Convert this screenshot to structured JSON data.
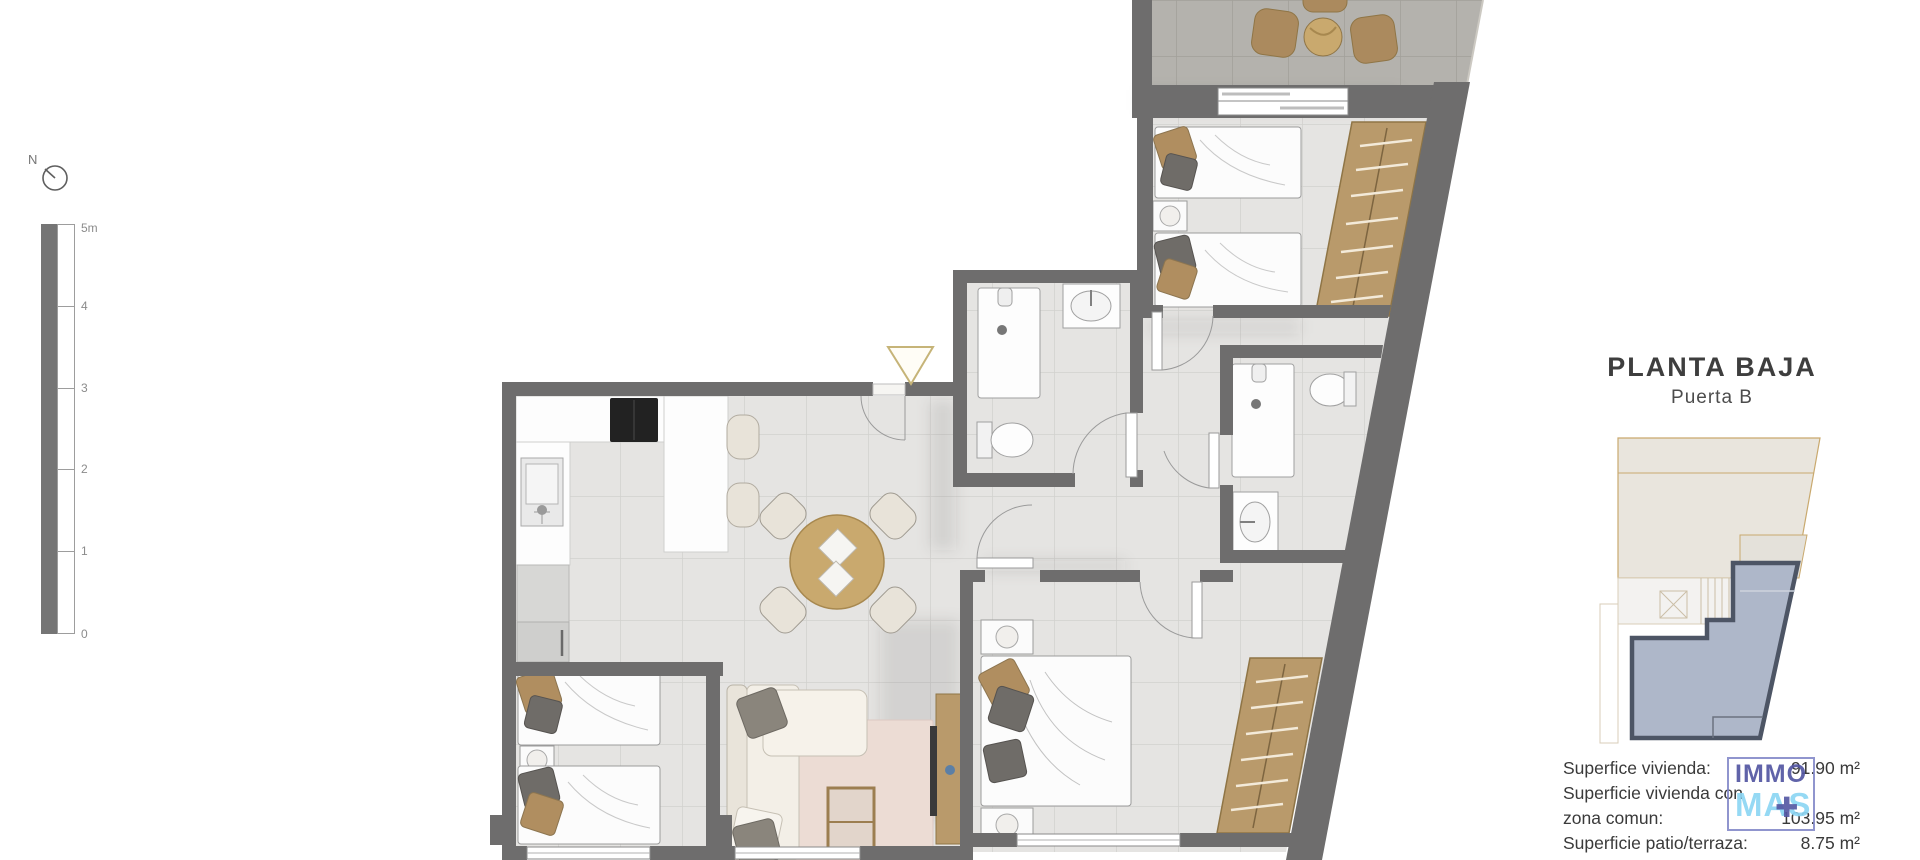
{
  "compass": {
    "label": "N"
  },
  "scale_bar": {
    "t5": "5m",
    "t4": "4",
    "t3": "3",
    "t2": "2",
    "t1": "1",
    "t0": "0"
  },
  "panel": {
    "title": "PLANTA BAJA",
    "subtitle": "Puerta B"
  },
  "areas": {
    "r1": {
      "label": "Superfice vivienda:",
      "value": "91.90 m²"
    },
    "r2": {
      "label": "Superficie vivienda con",
      "value": ""
    },
    "r3": {
      "label": "zona comun:",
      "value": "103.95 m²"
    },
    "r4": {
      "label": "Superficie patio/terraza:",
      "value": "8.75 m²"
    }
  },
  "logo": {
    "word1": "IMMO",
    "word2": "MAS",
    "mark": "✚"
  },
  "colors": {
    "wall": "#6e6d6d",
    "floor_tile": "#e5e4e2",
    "terrace_tile": "#b4b2ad",
    "wood": "#b99a6b",
    "keyplan_highlight_fill": "#aeb7c9",
    "keyplan_highlight_stroke": "#4d5565",
    "logo_primary": "#5356a2",
    "logo_secondary": "#8dd6f4",
    "entry_marker": "#c6b478"
  }
}
